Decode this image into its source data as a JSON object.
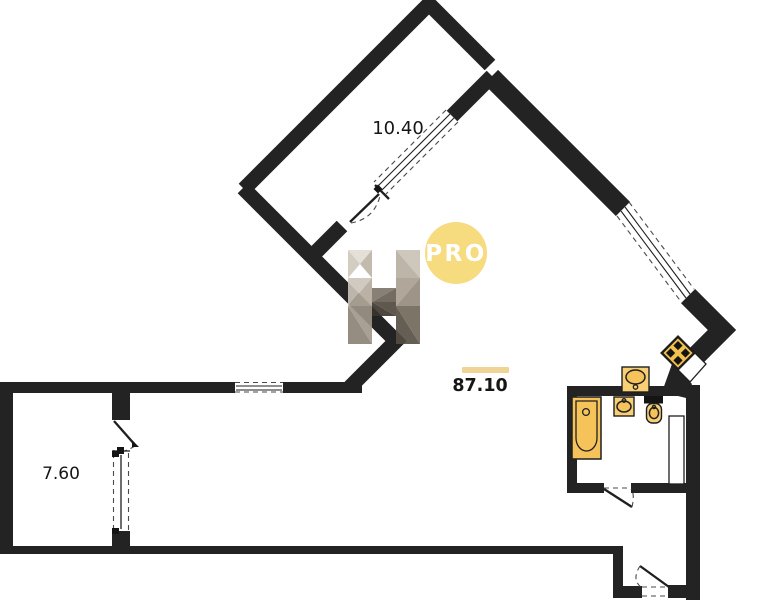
{
  "labels": {
    "room_top_area": "10.40",
    "room_left_area": "7.60",
    "total_area": "87.10"
  },
  "watermark": {
    "badge": "PRO"
  },
  "icons": {
    "bathtub": "bathtub-icon",
    "kitchen_sink": "sink-icon",
    "washbasin": "washbasin-icon",
    "toilet": "toilet-icon",
    "vent_shaft": "ventilation-shaft-icon"
  },
  "colors": {
    "wall": "#232323",
    "ink": "#1f1f1f",
    "dash": "#4a4a4a",
    "fixture": "#f6c35a",
    "fixture_light": "#f8cf74",
    "vent": "#f2c14e",
    "badge": "#f6db7f",
    "area_bar": "#efd496",
    "bg": "#ffffff"
  }
}
